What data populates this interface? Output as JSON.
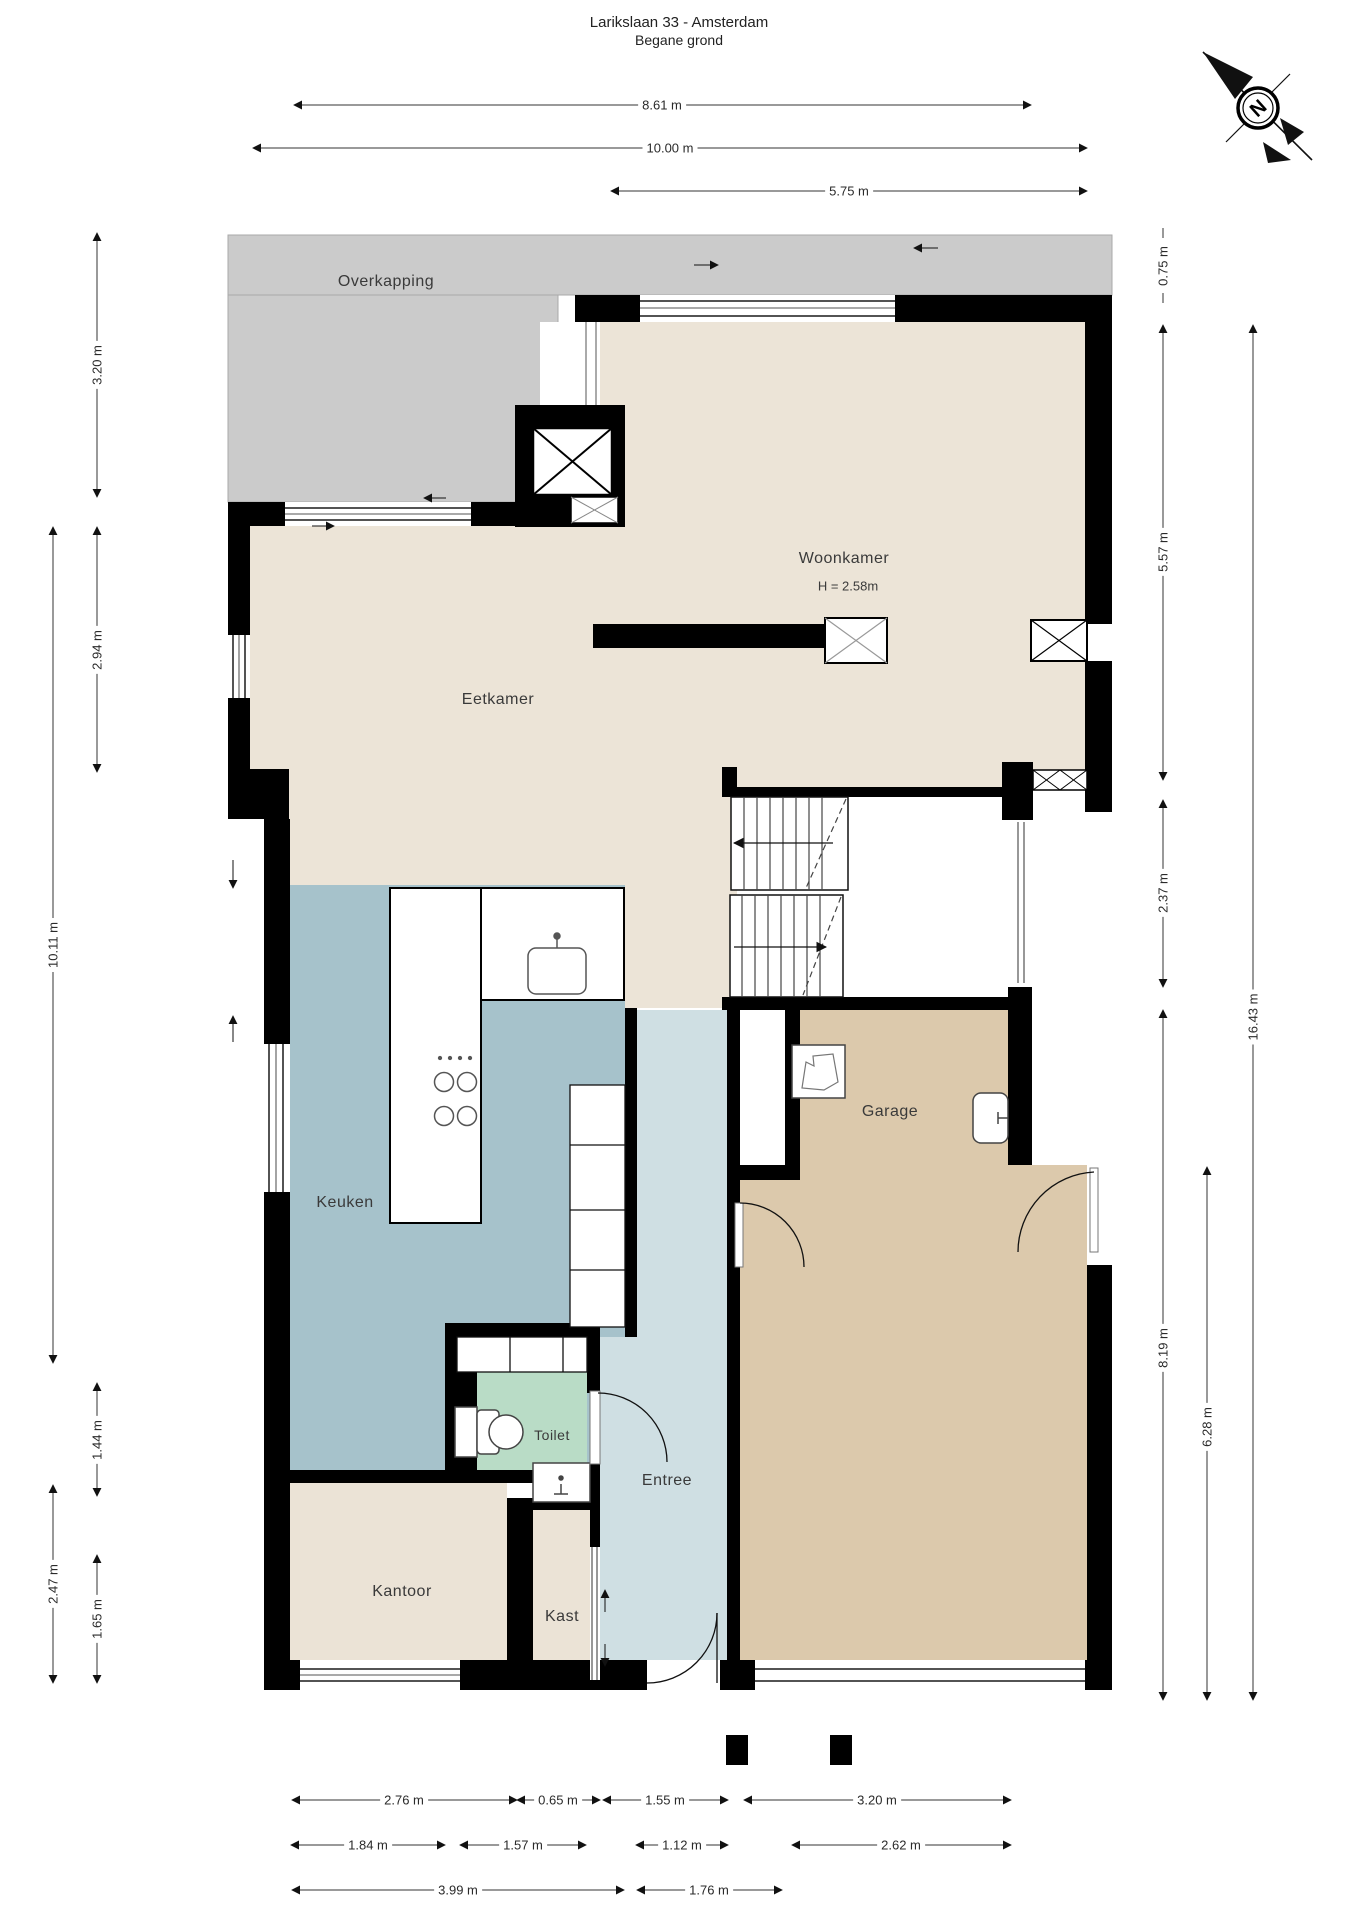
{
  "title": {
    "address": "Larikslaan 33 - Amsterdam",
    "floor": "Begane grond"
  },
  "compass": {
    "north_label": "N"
  },
  "rooms": {
    "overkapping": {
      "label": "Overkapping"
    },
    "woonkamer": {
      "label": "Woonkamer",
      "height_note": "H = 2.58m"
    },
    "eetkamer": {
      "label": "Eetkamer"
    },
    "keuken": {
      "label": "Keuken"
    },
    "toilet": {
      "label": "Toilet"
    },
    "entree": {
      "label": "Entree"
    },
    "garage": {
      "label": "Garage"
    },
    "kantoor": {
      "label": "Kantoor"
    },
    "kast": {
      "label": "Kast"
    }
  },
  "dimensions": {
    "top": [
      {
        "label": "8.61 m"
      },
      {
        "label": "10.00 m"
      },
      {
        "label": "5.75 m"
      }
    ],
    "left_inner": [
      {
        "label": "3.20 m"
      },
      {
        "label": "2.94 m"
      },
      {
        "label": "1.44 m"
      },
      {
        "label": "1.65 m"
      }
    ],
    "left_outer": [
      {
        "label": "10.11 m"
      },
      {
        "label": "2.47 m"
      }
    ],
    "right": [
      {
        "label": "0.75 m"
      },
      {
        "label": "5.57 m"
      },
      {
        "label": "2.37 m"
      },
      {
        "label": "8.19 m"
      },
      {
        "label": "6.28 m"
      },
      {
        "label": "16.43 m"
      }
    ],
    "bottom_row1": [
      {
        "label": "2.76 m"
      },
      {
        "label": "0.65 m"
      },
      {
        "label": "1.55 m"
      },
      {
        "label": "3.20 m"
      }
    ],
    "bottom_row2": [
      {
        "label": "1.84 m"
      },
      {
        "label": "1.57 m"
      },
      {
        "label": "1.12 m"
      },
      {
        "label": "2.62 m"
      }
    ],
    "bottom_row3": [
      {
        "label": "3.99 m"
      },
      {
        "label": "1.76 m"
      }
    ]
  },
  "colors": {
    "overkapping": "#cbcbcb",
    "living": "#ece4d7",
    "keuken": "#a6c2cb",
    "entree": "#cfdfe3",
    "toilet": "#b9dcc6",
    "garage": "#dcc9ac",
    "kantoor": "#ebe3d6",
    "wall": "#000000"
  }
}
